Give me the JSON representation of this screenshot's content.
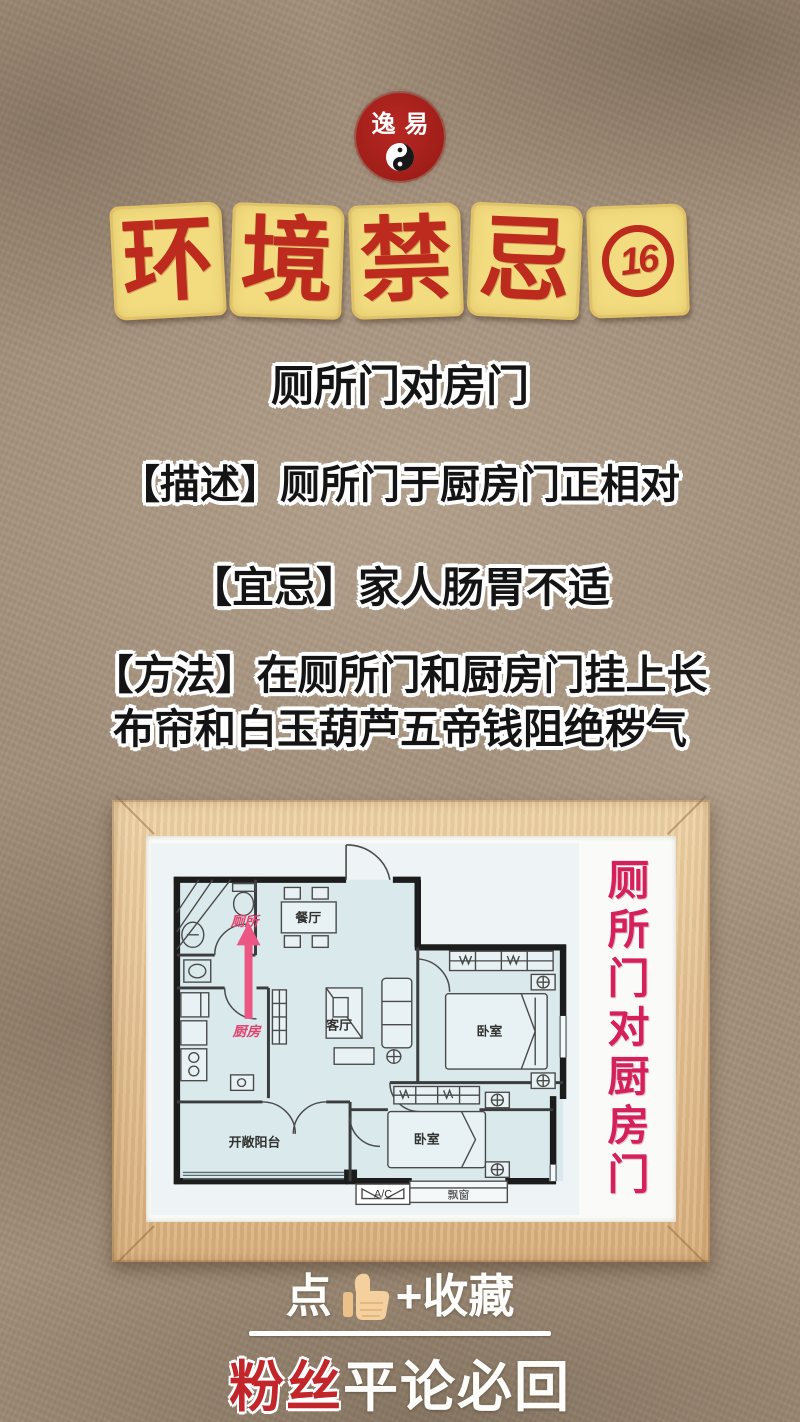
{
  "logo": {
    "name": "逸易"
  },
  "title": {
    "chars": [
      "环",
      "境",
      "禁",
      "忌"
    ],
    "badge": "16"
  },
  "headline": "厕所门对房门",
  "lines": {
    "desc": "【描述】厕所门于厨房门正相对",
    "yiji": "【宜忌】家人肠胃不适",
    "method1": "【方法】在厕所门和厨房门挂上长",
    "method2": "布帘和白玉葫芦五帝钱阻绝秽气"
  },
  "floorplan": {
    "labels": {
      "bathroom": "厕所",
      "kitchen": "厨房",
      "dining": "餐厅",
      "living": "客厅",
      "bedroom1": "卧室",
      "bedroom2": "卧室",
      "balcony": "开敞阳台",
      "bay": "飘窗",
      "ac": "A/C"
    },
    "caption": "厕所门对厨房门",
    "colors": {
      "arrow_accent": "#e0446e",
      "caption": "#d5205c",
      "wall": "#1c1c1c",
      "room_fill": "#d9e9ec",
      "frame_wood": "#e4c193"
    }
  },
  "cta": {
    "like_prefix": "点",
    "like_suffix": "+收藏",
    "fans": "粉丝",
    "rest": "平论必回"
  },
  "colors": {
    "tile_bg": "#f2dc7f",
    "title_red": "#bd2a1e",
    "seal_red": "#9e1d18",
    "paper": "#a3907b",
    "text_outline": "#ffffff"
  }
}
